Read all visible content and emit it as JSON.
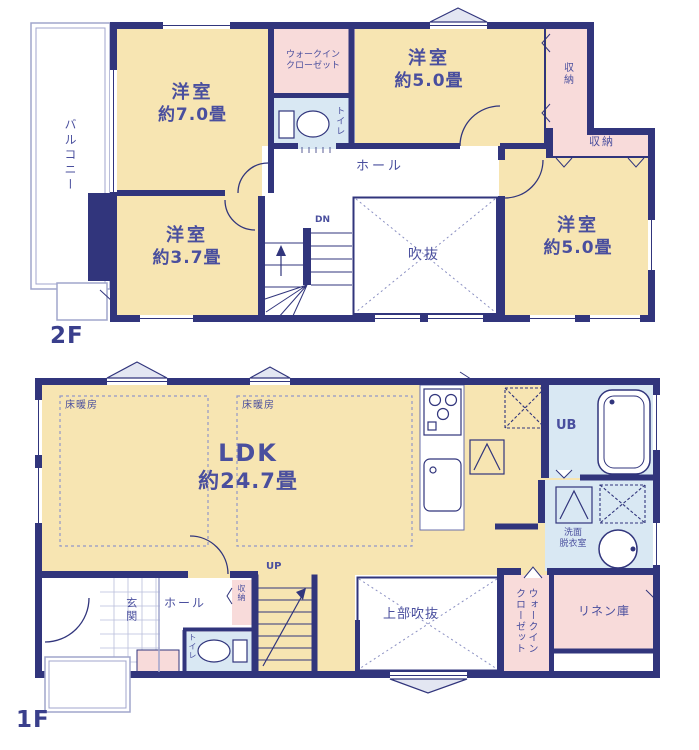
{
  "palette": {
    "wall": "#31357c",
    "room_cream": "#f7e5b2",
    "closet_pink": "#f8dbda",
    "bath_blue": "#d9e8f3",
    "label_text": "#4a4f9e",
    "outline_light": "#a0a5cc"
  },
  "floor2": {
    "label": "2F",
    "balcony_label": "バルコニー",
    "room_west": {
      "name": "洋室",
      "size": "約7.0畳"
    },
    "room_north": {
      "name": "洋室",
      "size": "約5.0畳"
    },
    "room_east": {
      "name": "洋室",
      "size": "約5.0畳"
    },
    "room_south": {
      "name": "洋室",
      "size": "約3.7畳"
    },
    "walkin_closet": {
      "line1": "ウォークイン",
      "line2": "クローゼット"
    },
    "toilet_label": "トイレ",
    "closet_north_label": "収納",
    "closet_east_label": "収納",
    "hall_label": "ホール",
    "stairs_label": "DN",
    "void_label": "吹抜"
  },
  "floor1": {
    "label": "1F",
    "ldk": {
      "name": "LDK",
      "size": "約24.7畳"
    },
    "floor_heating_west": "床暖房",
    "floor_heating_east": "床暖房",
    "stairs_label": "UP",
    "entrance_label": "玄関",
    "hall_label": "ホール",
    "closet_label": "収納",
    "toilet_label": "トイレ",
    "upper_void_label": "上部吹抜",
    "walkin_closet": {
      "line1": "ウォークイン",
      "line2": "クローゼット"
    },
    "linen_label": "リネン庫",
    "unit_bath_label": "UB",
    "washroom": {
      "line1": "洗面",
      "line2": "脱衣室"
    }
  }
}
